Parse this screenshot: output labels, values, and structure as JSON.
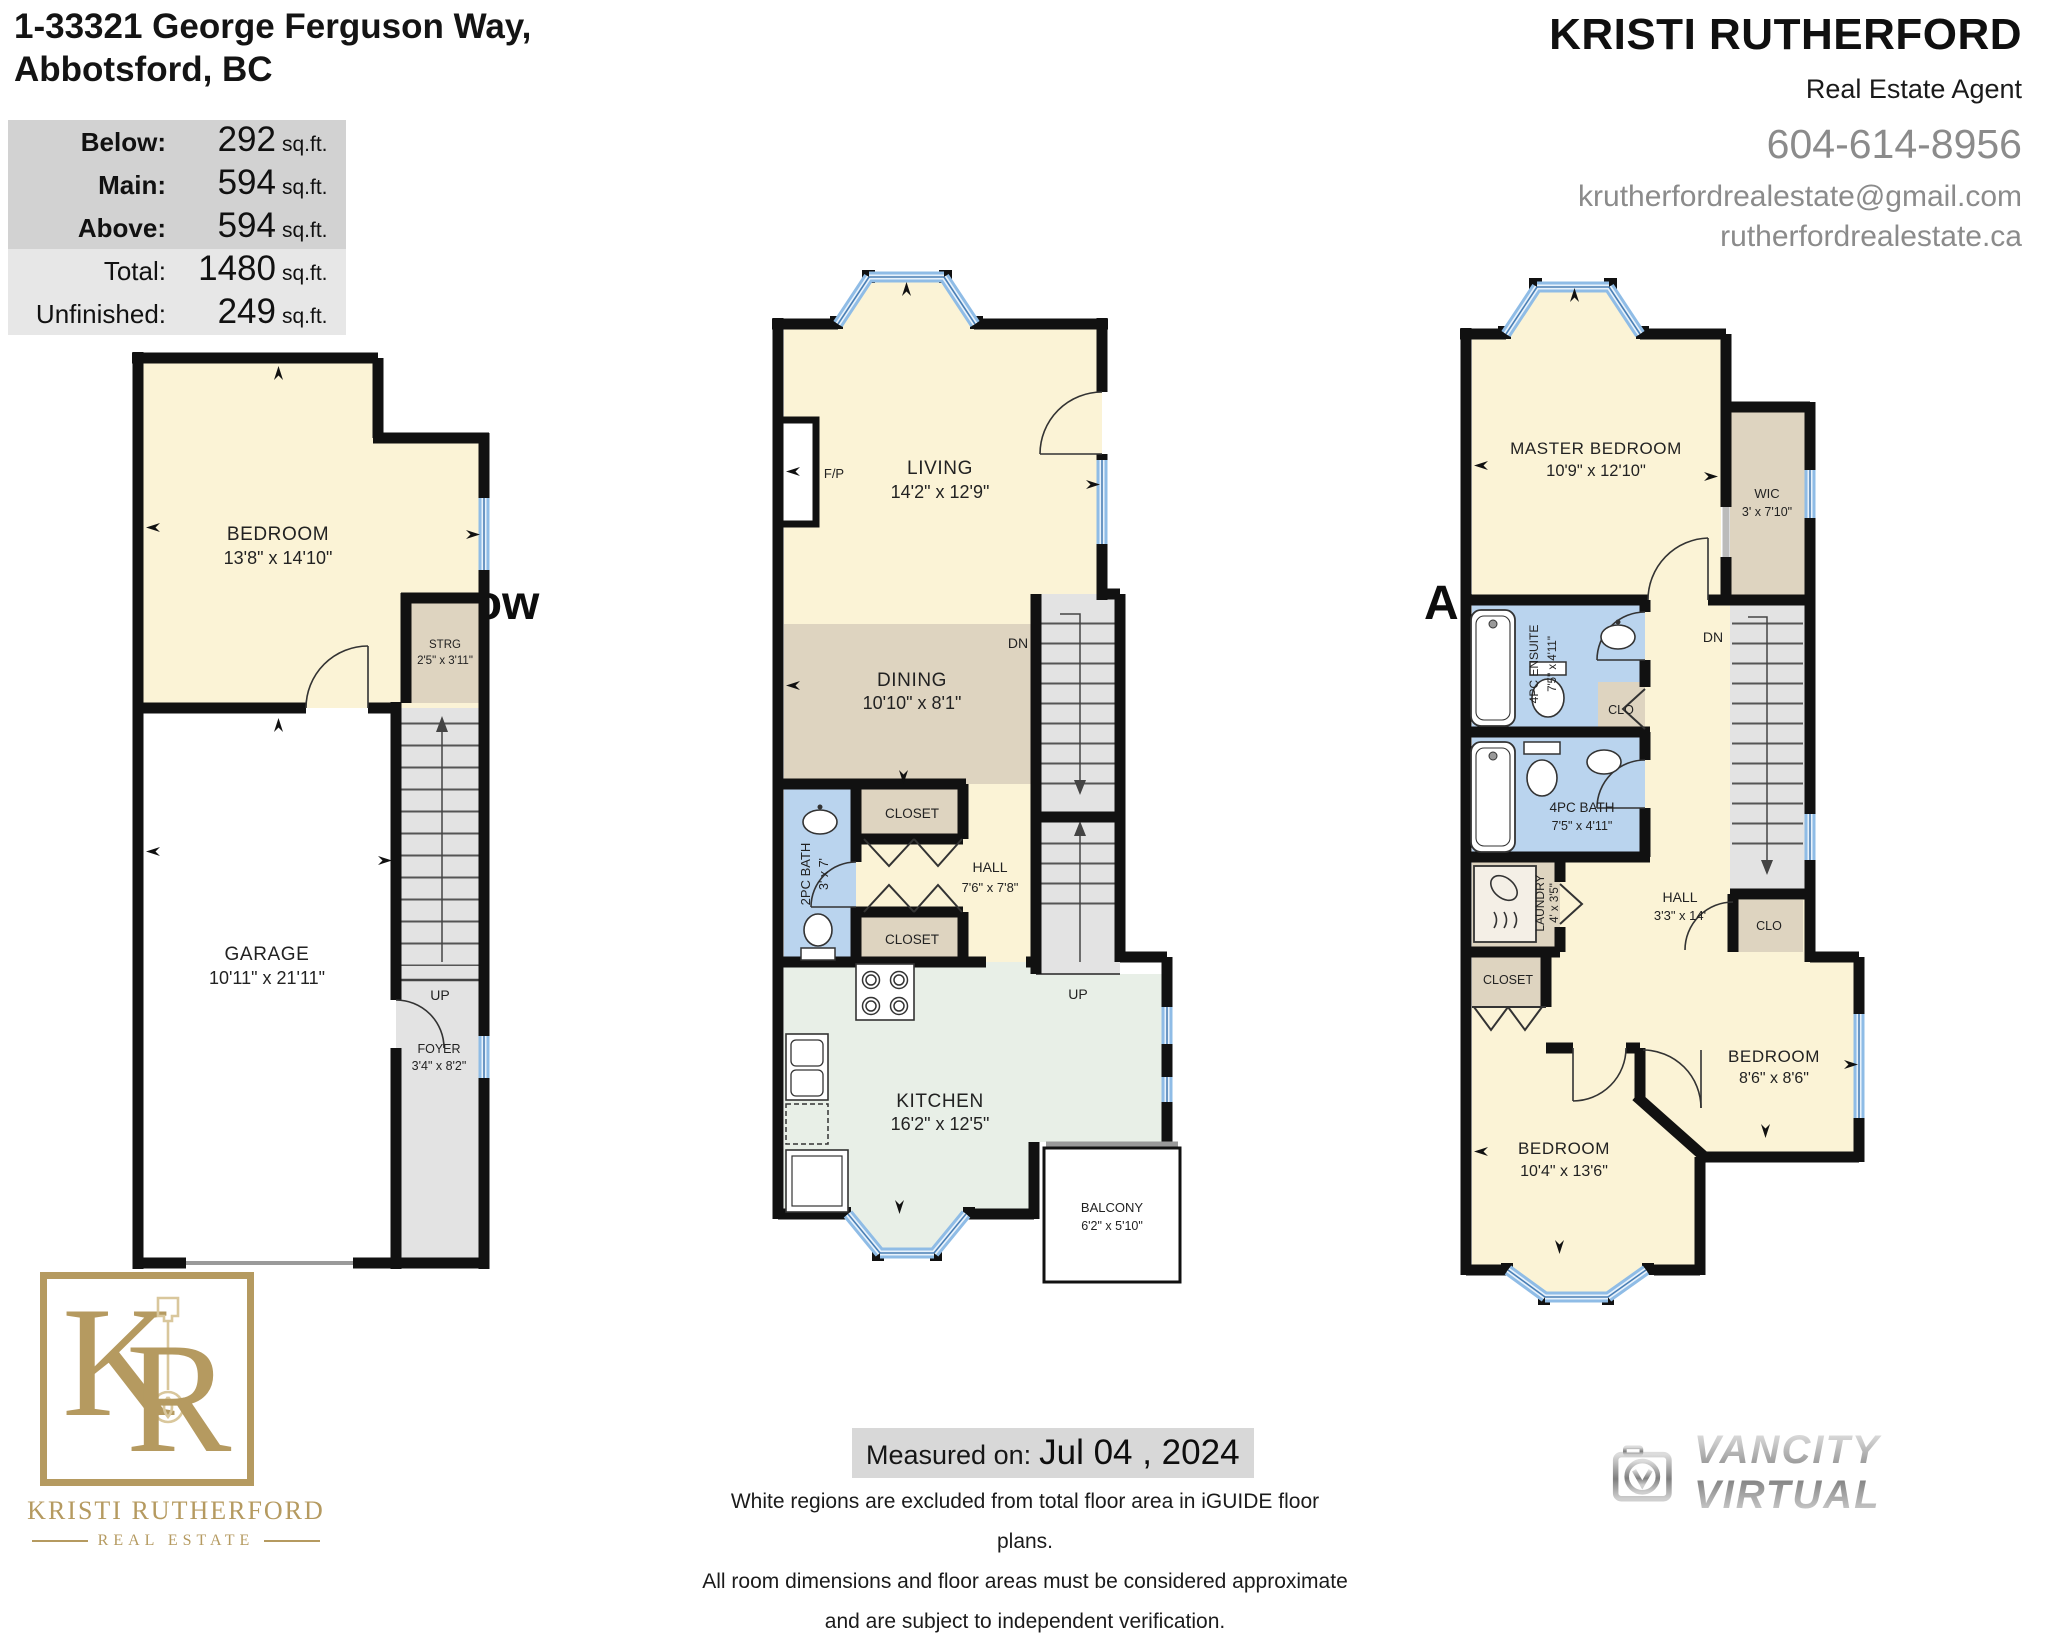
{
  "header": {
    "address_line1": "1-33321 George Ferguson Way,",
    "address_line2": "Abbotsford, BC",
    "area_table": {
      "rows": [
        {
          "label": "Below:",
          "value": "292",
          "unit": "sq.ft."
        },
        {
          "label": "Main:",
          "value": "594",
          "unit": "sq.ft."
        },
        {
          "label": "Above:",
          "value": "594",
          "unit": "sq.ft."
        },
        {
          "label": "Total:",
          "value": "1480",
          "unit": "sq.ft."
        },
        {
          "label": "Unfinished:",
          "value": "249",
          "unit": "sq.ft."
        }
      ]
    },
    "agent": {
      "name": "KRISTI RUTHERFORD",
      "title": "Real Estate Agent",
      "phone": "604-614-8956",
      "email": "krutherfordrealestate@gmail.com",
      "website": "rutherfordrealestate.ca"
    }
  },
  "plans": {
    "below": {
      "label": "Below",
      "up": "UP",
      "rooms": {
        "bedroom": {
          "name": "BEDROOM",
          "dims": "13'8\" x 14'10\""
        },
        "strg": {
          "name": "STRG",
          "dims": "2'5\" x 3'11\""
        },
        "garage": {
          "name": "GARAGE",
          "dims": "10'11\" x 21'11\""
        },
        "foyer": {
          "name": "FOYER",
          "dims": "3'4\" x 8'2\""
        }
      }
    },
    "main": {
      "label": "Main",
      "dn": "DN",
      "up": "UP",
      "rooms": {
        "living": {
          "name": "LIVING",
          "dims": "14'2\" x 12'9\""
        },
        "fireplace": "F/P",
        "dining": {
          "name": "DINING",
          "dims": "10'10\" x 8'1\""
        },
        "bath": {
          "name": "2PC BATH",
          "dims": "3' x 7'"
        },
        "closet_a": "CLOSET",
        "closet_b": "CLOSET",
        "hall": {
          "name": "HALL",
          "dims": "7'6\" x 7'8\""
        },
        "kitchen": {
          "name": "KITCHEN",
          "dims": "16'2\" x 12'5\""
        },
        "balcony": {
          "name": "BALCONY",
          "dims": "6'2\" x 5'10\""
        }
      }
    },
    "above": {
      "label": "Above",
      "dn": "DN",
      "rooms": {
        "master": {
          "name": "MASTER BEDROOM",
          "dims": "10'9\" x 12'10\""
        },
        "wic": {
          "name": "WIC",
          "dims": "3' x 7'10\""
        },
        "ensuite": {
          "name": "4PC ENSUITE",
          "dims": "7'5\" x 4'11\""
        },
        "clo_a": "CLO",
        "bath": {
          "name": "4PC BATH",
          "dims": "7'5\" x 4'11\""
        },
        "laundry": {
          "name": "LAUNDRY",
          "dims": "4' x 3'5\""
        },
        "hall": {
          "name": "HALL",
          "dims": "3'3\" x 14'"
        },
        "closet": "CLOSET",
        "clo_b": "CLO",
        "bedroom1": {
          "name": "BEDROOM",
          "dims": "10'4\" x 13'6\""
        },
        "bedroom2": {
          "name": "BEDROOM",
          "dims": "8'6\" x 8'6\""
        }
      }
    }
  },
  "footer": {
    "logo": {
      "monogram_k": "K",
      "monogram_r": "R",
      "name": "KRISTI RUTHERFORD",
      "subtitle": "REAL ESTATE"
    },
    "measured": {
      "label": "Measured on:",
      "date": "Jul 04 , 2024"
    },
    "disclaimer": [
      "White regions are excluded from total floor area in iGUIDE floor plans.",
      "All room dimensions and floor areas must be considered approximate",
      "and are subject to independent verification."
    ],
    "vancity": "VANCITY VIRTUAL"
  },
  "colors": {
    "gold": "#b59a60",
    "wall": "#111111",
    "window_blue": "#8fbce6",
    "bath_blue": "#bad4ee",
    "cream": "#fbf3d6",
    "tan": "#ded4c0",
    "kitchen_green": "#e8efe7",
    "stair_gray": "#e3e3e3",
    "text_gray": "#8b8b8b"
  }
}
